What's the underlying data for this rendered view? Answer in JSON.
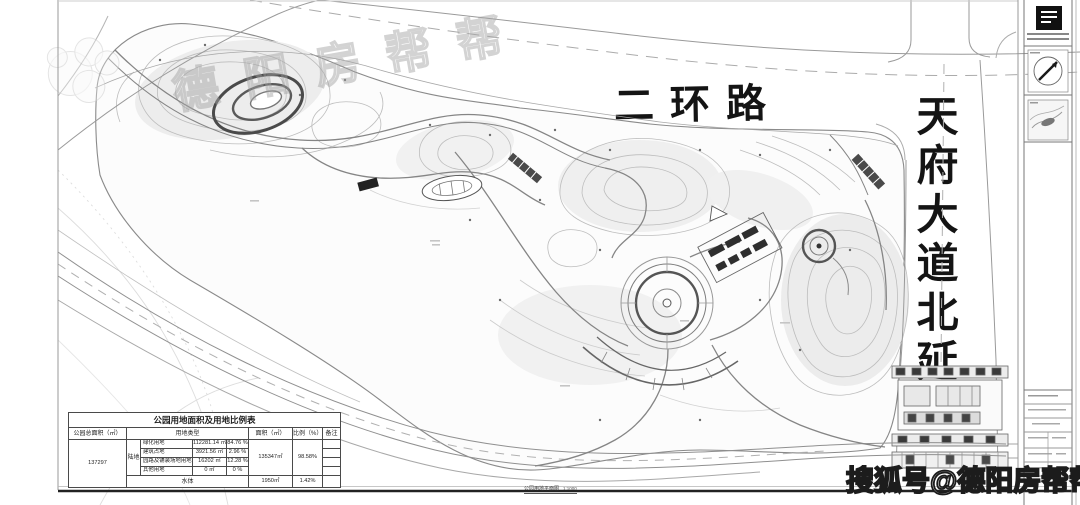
{
  "plan_labels": {
    "ring_road": "二环路",
    "tianfu_avenue": "天府大道北延线"
  },
  "watermarks": {
    "sohu_badge": "搜狐号@德阳房帮帮",
    "faint_text": "德阳房帮帮"
  },
  "caption": {
    "title": "公园用地平面图",
    "scale": "1:1000"
  },
  "land_table": {
    "title": "公园用地面积及用地比例表",
    "headers": [
      "公园总面积（㎡）",
      "用地类型",
      "面积（㎡）",
      "比例（%）",
      "备注"
    ],
    "total_area": "137297",
    "land_group_label": "陆地",
    "sub_rows": [
      {
        "name": "绿化用地",
        "area": "112281.14 ㎡",
        "ratio": "84.76 %"
      },
      {
        "name": "建筑占地",
        "area": "3921.56 ㎡",
        "ratio": "2.96 %"
      },
      {
        "name": "园路及铺装场地用地",
        "area": "16202 ㎡",
        "ratio": "12.28 %"
      },
      {
        "name": "其他用地",
        "area": "0 ㎡",
        "ratio": "0 %"
      }
    ],
    "land_total": {
      "area": "135347㎡",
      "ratio": "98.58%"
    },
    "water_row": {
      "name": "水体",
      "area": "1950㎡",
      "ratio": "1.42%"
    }
  }
}
